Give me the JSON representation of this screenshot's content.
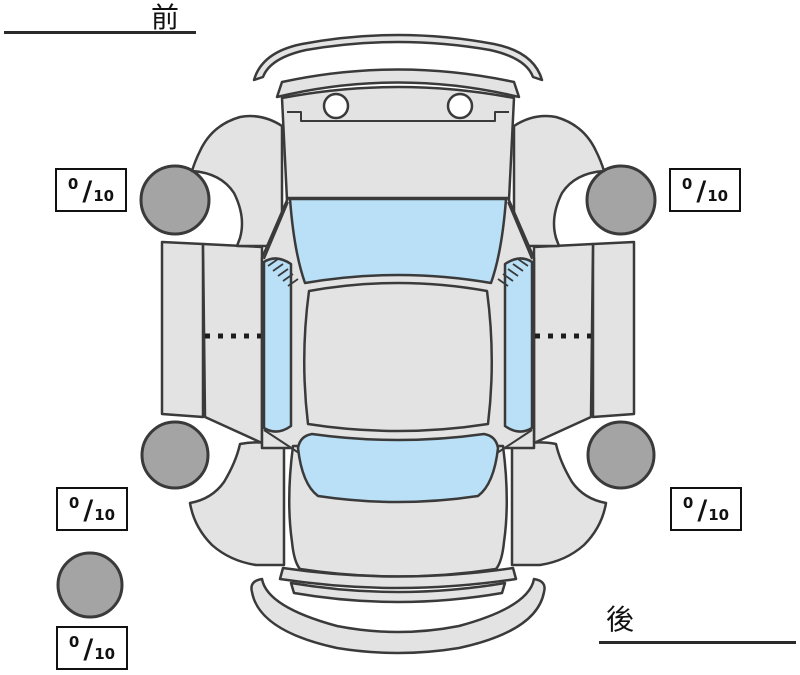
{
  "diagram": {
    "title": "vehicle-top-view-condition-diagram",
    "front_label": "前",
    "rear_label": "後",
    "tread_separator": "/",
    "tread_boxes": [
      {
        "position": "front-left",
        "value": "0",
        "max": "10"
      },
      {
        "position": "front-right",
        "value": "0",
        "max": "10"
      },
      {
        "position": "rear-left",
        "value": "0",
        "max": "10"
      },
      {
        "position": "rear-right",
        "value": "0",
        "max": "10"
      },
      {
        "position": "spare",
        "value": "0",
        "max": "10"
      }
    ],
    "colors": {
      "body": "#e3e3e3",
      "glass": "#b9e0f6",
      "tire": "#a4a4a4",
      "outline": "#3a3a3a",
      "background": "#ffffff"
    }
  }
}
